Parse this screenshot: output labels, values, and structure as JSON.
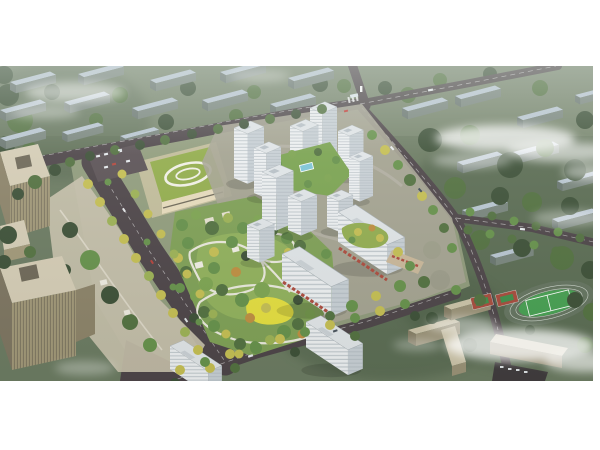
{
  "image": {
    "kind": "aerial architectural rendering",
    "description": "Bird's-eye masterplan rendering of a new residential development: a cluster of white high-rise apartment towers with a large landscaped central park, a green-roofed kindergarten, tree-lined boulevards, street-front commercial slabs, neighboring tan office towers on the left, a school campus with running-track sports field and basketball courts at lower right, and rows of existing apartment blocks fading into haze in the background.",
    "width_px": 600,
    "height_px": 450
  },
  "scene": {
    "areas": [
      "city-backdrop-blocks",
      "road-network",
      "left-office-towers",
      "kindergarten",
      "central-park",
      "residential-tower-cluster",
      "commercial-street-slabs",
      "school-campus",
      "sports-field",
      "basketball-courts",
      "clouds-and-haze"
    ]
  },
  "colors": {
    "page_bg": "#ffffff",
    "land_light": "#7d8a72",
    "land_mid": "#6b7a61",
    "land_dark": "#4d5e47",
    "tree_dark": "#3c4f36",
    "tree_mid": "#52703f",
    "tree_green": "#66914a",
    "tree_bright": "#7da450",
    "tree_lime": "#9db254",
    "tree_yellow": "#c6bf52",
    "tree_orange": "#c08e3f",
    "bg_roof": "#b9c6d2",
    "bg_face": "#78847c",
    "bg_end": "#68746e",
    "road_dark": "#4c4347",
    "road_mid": "#5a5054",
    "road_light": "#8e8788",
    "path_white": "#eceade",
    "site_ground": "#a7a493",
    "plaza_tan": "#c9c1ac",
    "tower_front": "#eff1f3",
    "tower_side": "#c9d0d6",
    "tower_roof": "#e2e6e9",
    "tower_stripe": "#9fa9b1",
    "podium_red": "#ae4a3d",
    "podium_tan": "#cbb89a",
    "kg_roof": "#93ad4b",
    "kg_wall": "#e9dcbd",
    "office_roof": "#d6cdb6",
    "office_face": "#a29878",
    "office_dark": "#6e6757",
    "field_green": "#46a051",
    "track_gray": "#64735f",
    "court_red": "#a84a3c",
    "court_green": "#3f8f4a",
    "campus_roof": "#cdc4a9",
    "campus_face": "#9a9176",
    "campus_end": "#857c63",
    "playground_yellow": "#e6df3e",
    "pool_blue": "#7ec6d8",
    "cloud": "#ffffff",
    "parking_dark": "#3f3a3c"
  }
}
